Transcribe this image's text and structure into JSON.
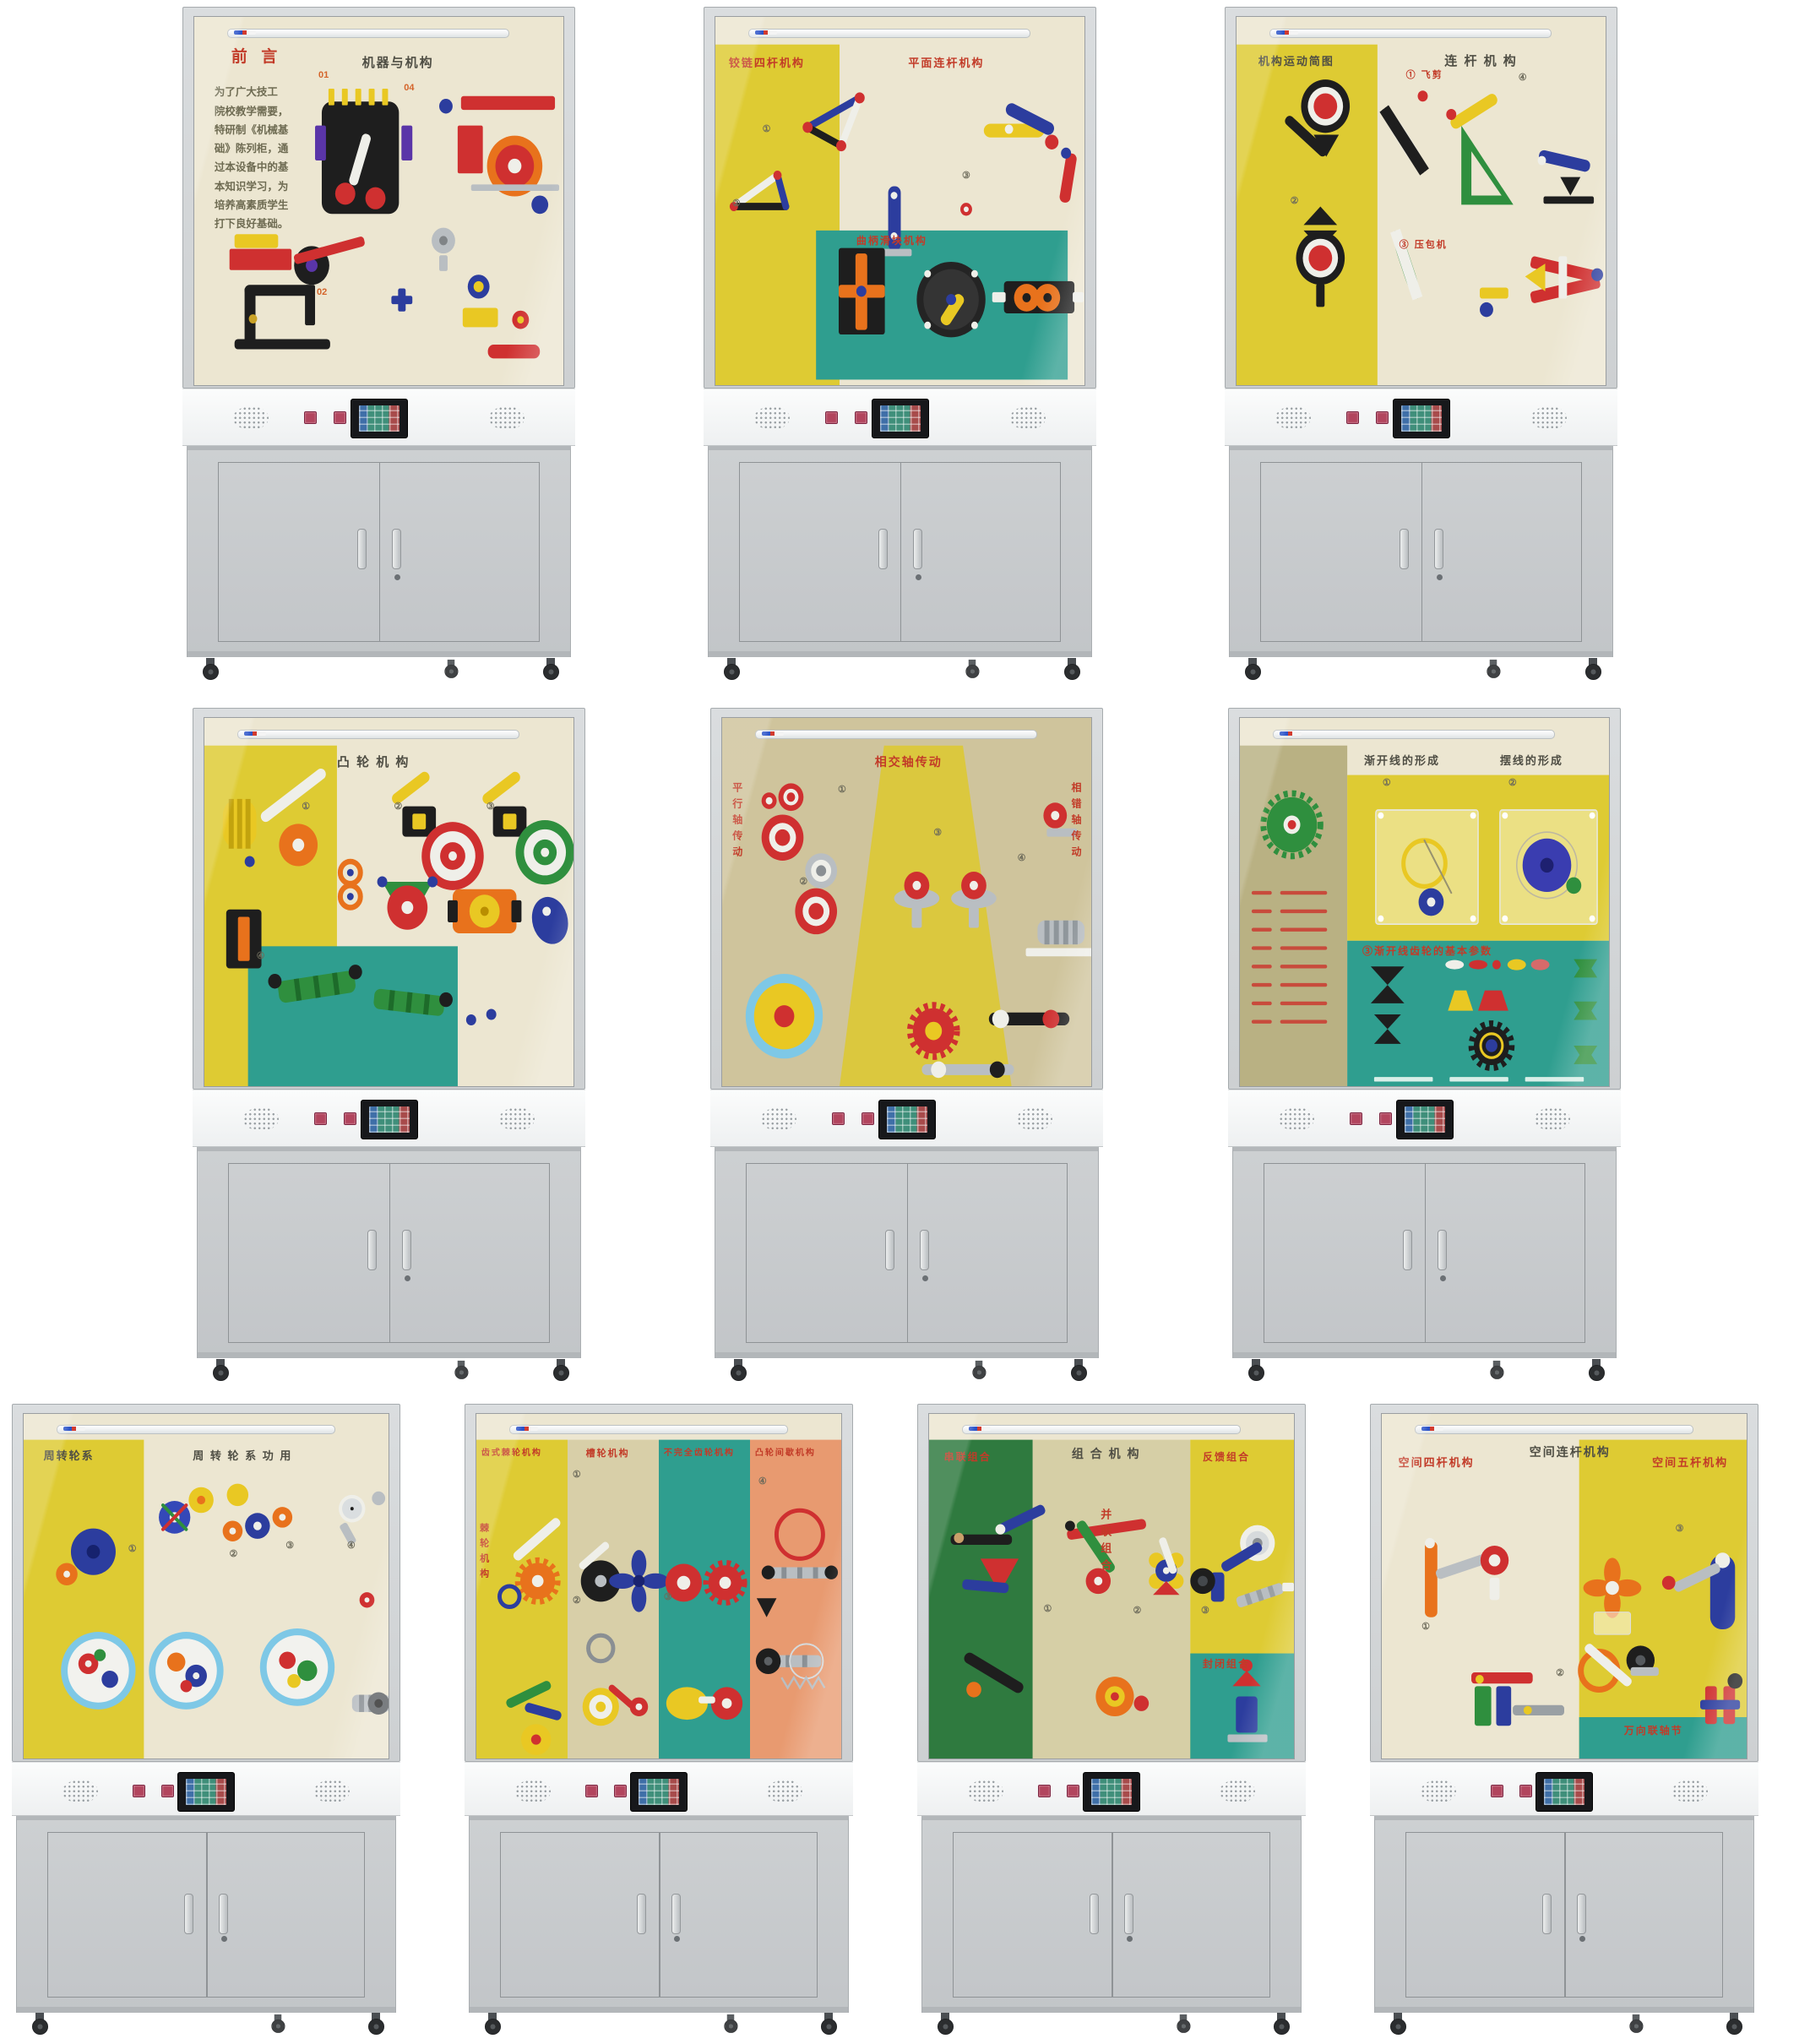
{
  "page": {
    "background": "#ffffff",
    "description": "十台《机械基础》教学陈列柜产品图"
  },
  "palette": {
    "frame": "#d2d5d7",
    "frame_edge": "#a6abae",
    "backboard": "#ece6d1",
    "panel_yellow": "#decb33",
    "panel_teal": "#2f9e8f",
    "panel_olive": "#b9b183",
    "panel_tan": "#d8cfa8",
    "panel_salmon": "#e89a70",
    "panel_green": "#2f7a3f",
    "panel_khaki": "#d6cfa6",
    "panel_olive_bg": "#cfc49c",
    "title_red": "#c23b28",
    "title_dark": "#4f4e44",
    "marker_orange": "#d4642a",
    "console_button": "#b2455e",
    "base_gray": "#c6c9cb"
  },
  "console": {
    "speakers": 2,
    "buttons": 2,
    "screen": "touchscreen-grid"
  },
  "cabinets": [
    {
      "name": "机器与机构",
      "titles": [
        {
          "text": "前  言",
          "color": "red"
        },
        {
          "text": "机器与机构",
          "color": "dark"
        }
      ],
      "markers": [
        "01",
        "04",
        "02"
      ],
      "preface": "为了广大技工\n院校教学需要，\n特研制《机械基\n础》陈列柜，通\n过本设备中的基\n本知识学习，为\n培养高素质学生\n打下良好基础。"
    },
    {
      "name": "平面连杆机构",
      "titles": [
        {
          "text": "铰链四杆机构",
          "color": "red"
        },
        {
          "text": "平面连杆机构",
          "color": "red"
        },
        {
          "text": "曲柄滑块机构",
          "color": "red"
        }
      ],
      "markers": [
        "①",
        "②",
        "③"
      ]
    },
    {
      "name": "连杆机构",
      "titles": [
        {
          "text": "机构运动简图",
          "color": "dark"
        },
        {
          "text": "连 杆 机 构",
          "color": "dark"
        },
        {
          "text": "① 飞剪",
          "color": "red"
        },
        {
          "text": "③ 压包机",
          "color": "red"
        }
      ],
      "markers": [
        "②",
        "④"
      ]
    },
    {
      "name": "凸轮机构",
      "titles": [
        {
          "text": "凸 轮 机 构",
          "color": "dark"
        }
      ],
      "markers": [
        "①",
        "②",
        "③",
        "④"
      ]
    },
    {
      "name": "齿轮传动",
      "titles": [
        {
          "text": "相交轴传动",
          "color": "red"
        },
        {
          "text": "平行轴传动",
          "color": "red"
        },
        {
          "text": "相错轴传动",
          "color": "red"
        }
      ],
      "markers": [
        "①",
        "②",
        "③",
        "④"
      ]
    },
    {
      "name": "渐开线齿轮",
      "titles": [
        {
          "text": "渐开线的形成",
          "color": "dark"
        },
        {
          "text": "摆线的形成",
          "color": "dark"
        },
        {
          "text": "③渐开线齿轮的基本参数",
          "color": "red"
        }
      ],
      "markers": [
        "①",
        "②"
      ]
    },
    {
      "name": "周转轮系",
      "titles": [
        {
          "text": "周转轮系",
          "color": "dark"
        },
        {
          "text": "周 转 轮 系 功 用",
          "color": "dark"
        }
      ],
      "markers": [
        "①",
        "②",
        "③",
        "④"
      ]
    },
    {
      "name": "间歇运动机构",
      "titles": [
        {
          "text": "齿式棘轮机构",
          "color": "red"
        },
        {
          "text": "槽轮机构",
          "color": "red"
        },
        {
          "text": "不完全齿轮机构",
          "color": "red"
        },
        {
          "text": "凸轮间歇机构",
          "color": "red"
        },
        {
          "text": "棘轮机构",
          "color": "red"
        }
      ],
      "markers": [
        "①",
        "②",
        "③",
        "④"
      ]
    },
    {
      "name": "组合机构",
      "titles": [
        {
          "text": "串联组合",
          "color": "red"
        },
        {
          "text": "组 合 机 构",
          "color": "dark"
        },
        {
          "text": "并联组合",
          "color": "red"
        },
        {
          "text": "反馈组合",
          "color": "red"
        },
        {
          "text": "封闭组合",
          "color": "red"
        }
      ],
      "markers": [
        "①",
        "②",
        "③"
      ]
    },
    {
      "name": "空间连杆机构",
      "titles": [
        {
          "text": "空间四杆机构",
          "color": "red"
        },
        {
          "text": "空间连杆机构",
          "color": "dark"
        },
        {
          "text": "空间五杆机构",
          "color": "red"
        },
        {
          "text": "万向联轴节",
          "color": "red"
        }
      ],
      "markers": [
        "①",
        "②",
        "③"
      ]
    }
  ]
}
